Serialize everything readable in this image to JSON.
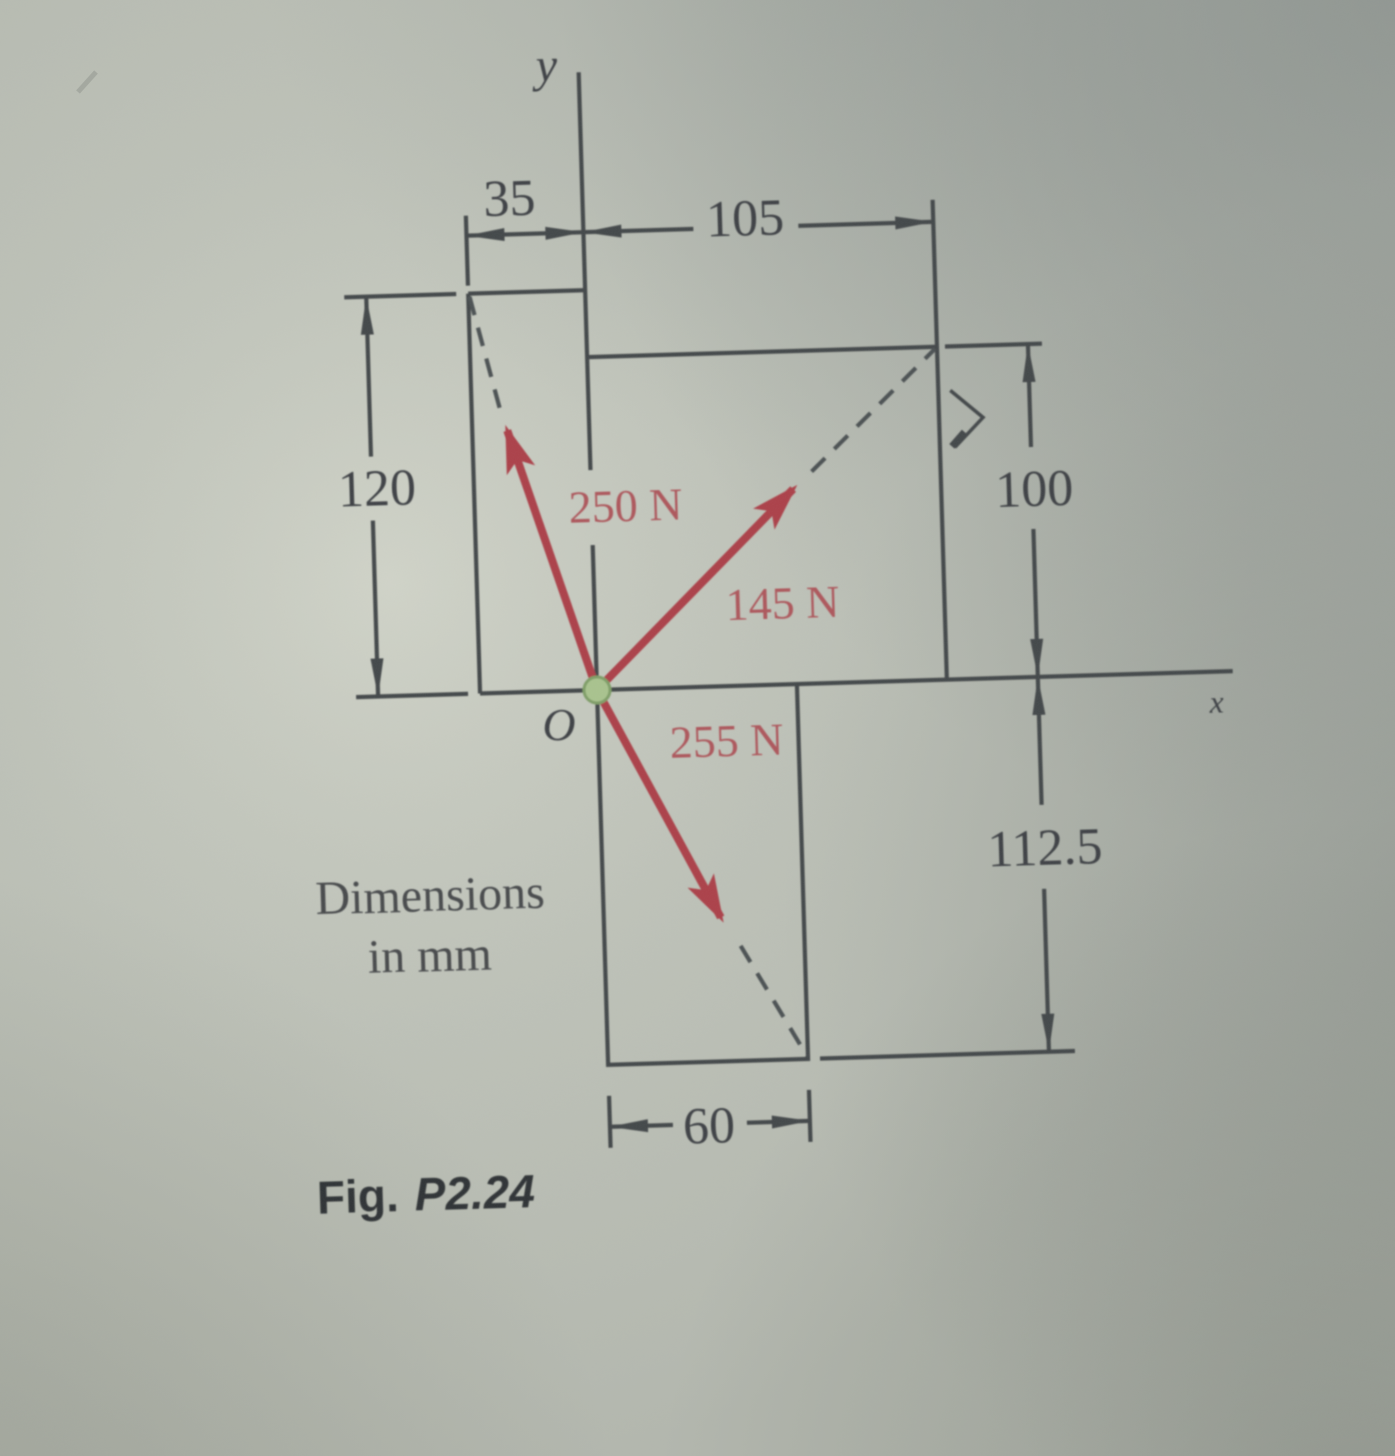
{
  "figure": {
    "caption": {
      "prefix": "Fig.",
      "number": "P2.24"
    },
    "note": {
      "line1": "Dimensions",
      "line2": "in mm"
    },
    "axes": {
      "x_label": "x",
      "y_label": "y",
      "origin_label": "O"
    },
    "forces": [
      {
        "label": "250 N",
        "direction": "up-left from O",
        "slope_triangle_mm": {
          "horizontal": 35,
          "vertical": 120
        }
      },
      {
        "label": "145 N",
        "direction": "up-right from O",
        "slope_triangle_mm": {
          "horizontal": 105,
          "vertical": 100
        }
      },
      {
        "label": "255 N",
        "direction": "down-right from O",
        "slope_triangle_mm": {
          "horizontal": 60,
          "vertical": 112.5
        }
      }
    ],
    "dimensions_mm": {
      "top_left_width": "35",
      "top_right_width": "105",
      "left_height": "120",
      "right_height": "100",
      "lower_right_height": "112.5",
      "bottom_width": "60"
    },
    "colors": {
      "force_arrow": "#ac4149",
      "force_label": "#ad565c",
      "line": "#43474a",
      "origin_dot_fill": "#a9c38e",
      "origin_dot_stroke": "#7f9e67",
      "paper": "#b4b8af"
    }
  }
}
